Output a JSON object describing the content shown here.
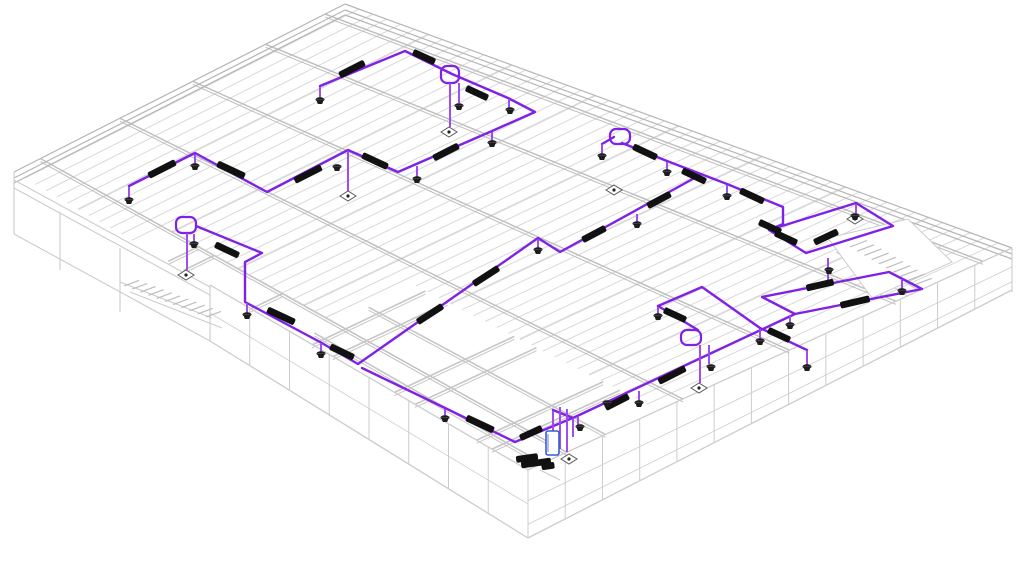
{
  "view": {
    "description": "3D isometric BIM view of single-storey building roof framing with electrical conduit layout",
    "width": 1024,
    "height": 563,
    "colors": {
      "background": "#ffffff",
      "conduit": "#8021e6",
      "conduit_light": "#9b45f0",
      "joist": "#d9d9d9",
      "girder": "#bdbdbd",
      "edge": "#b5b5b5",
      "wall": "#cccccc",
      "partition": "#c6c6c6",
      "fitting": "#111111",
      "fixture": "#1c1c1c",
      "plate_stroke": "#5a5a5a",
      "plate_fill": "#ffffff",
      "panel": "#3a5bd0"
    },
    "roof": {
      "corner_n": [
        345,
        4
      ],
      "corner_e": [
        1012,
        248
      ],
      "corner_s": [
        528,
        470
      ],
      "corner_w": [
        14,
        172
      ],
      "joist_count": 48,
      "joist_clips": [
        [
          0.0,
          1.0
        ],
        [
          0.25,
          0.92
        ],
        [
          0.56,
          0.73
        ]
      ],
      "girders": [
        0.06,
        0.24,
        0.46,
        0.68,
        0.92
      ],
      "edge_offsets": [
        0,
        6,
        11
      ]
    },
    "rooms": [
      [
        0.58,
        0.73,
        0.58,
        1.0
      ],
      [
        0.62,
        0.73,
        0.62,
        1.0
      ],
      [
        0.74,
        0.73,
        0.74,
        1.0
      ],
      [
        0.78,
        0.73,
        0.78,
        1.0
      ],
      [
        0.9,
        0.73,
        0.9,
        1.0
      ],
      [
        0.93,
        0.73,
        0.93,
        1.0
      ],
      [
        0.56,
        0.84,
        1.0,
        0.84
      ],
      [
        0.56,
        0.97,
        1.0,
        0.97
      ],
      [
        0.3,
        0.92,
        0.3,
        1.0
      ],
      [
        0.33,
        0.92,
        0.33,
        1.0
      ],
      [
        0.46,
        0.92,
        0.46,
        1.0
      ],
      [
        0.28,
        0.92,
        0.56,
        0.92
      ]
    ],
    "walls": [
      {
        "top": [
          [
            1012,
            248
          ],
          [
            528,
            470
          ]
        ],
        "drops": [
          42,
          68
        ],
        "verticals": 13,
        "bands": [
          0.45,
          0.8
        ]
      },
      {
        "top": [
          [
            210,
            285
          ],
          [
            528,
            470
          ]
        ],
        "drops": [
          56,
          68
        ],
        "verticals": 8,
        "bands": [
          0.5
        ]
      }
    ],
    "gray_lines": [
      [
        14,
        172,
        14,
        234
      ],
      [
        14,
        234,
        210,
        341
      ],
      [
        210,
        285,
        210,
        341
      ],
      [
        14,
        180,
        210,
        287
      ],
      [
        14,
        188,
        210,
        295
      ],
      [
        120,
        248,
        120,
        312
      ],
      [
        60,
        212,
        60,
        270
      ],
      [
        1012,
        248,
        1012,
        292
      ],
      [
        120,
        282,
        212,
        318
      ],
      [
        130,
        292,
        222,
        328
      ],
      [
        846,
        246,
        918,
        290
      ],
      [
        836,
        252,
        908,
        296
      ],
      [
        540,
        470,
        560,
        480
      ]
    ],
    "stair_void": [
      [
        828,
        238
      ],
      [
        908,
        219
      ],
      [
        952,
        262
      ],
      [
        872,
        298
      ]
    ],
    "stairs": [
      {
        "origin": [
          124,
          286
        ],
        "step": [
          8.2,
          3.1
        ],
        "n": 11,
        "tread": [
          15,
          -5.6
        ]
      },
      {
        "origin": [
          850,
          247
        ],
        "step": [
          7.2,
          4.2
        ],
        "n": 10,
        "tread": [
          17,
          -6.5
        ]
      }
    ],
    "conduit_runs": [
      [
        [
          129,
          186
        ],
        [
          195,
          153
        ],
        [
          267,
          192
        ],
        [
          348,
          150
        ],
        [
          398,
          172
        ],
        [
          492,
          131
        ],
        [
          535,
          112
        ],
        [
          508,
          98
        ],
        [
          452,
          74
        ],
        [
          405,
          51
        ],
        [
          320,
          86
        ]
      ],
      [
        [
          196,
          226
        ],
        [
          262,
          253
        ],
        [
          245,
          262
        ],
        [
          245,
          302
        ],
        [
          320,
          342
        ],
        [
          358,
          364
        ],
        [
          538,
          238
        ],
        [
          560,
          252
        ],
        [
          700,
          175
        ]
      ],
      [
        [
          622,
          143
        ],
        [
          667,
          161
        ],
        [
          727,
          184
        ],
        [
          783,
          207
        ],
        [
          783,
          224
        ],
        [
          769,
          230
        ],
        [
          856,
          203
        ],
        [
          893,
          226
        ],
        [
          806,
          253
        ],
        [
          769,
          230
        ]
      ],
      [
        [
          362,
          368
        ],
        [
          445,
          408
        ],
        [
          515,
          442
        ],
        [
          575,
          417
        ],
        [
          795,
          314
        ],
        [
          762,
          297
        ],
        [
          889,
          272
        ],
        [
          922,
          289
        ],
        [
          795,
          314
        ]
      ],
      [
        [
          658,
          306
        ],
        [
          702,
          287
        ],
        [
          760,
          328
        ],
        [
          807,
          350
        ]
      ],
      [
        [
          658,
          306
        ],
        [
          698,
          330
        ]
      ],
      [
        [
          553,
          410
        ],
        [
          573,
          418
        ]
      ],
      [
        [
          602,
          144
        ],
        [
          614,
          137
        ]
      ]
    ],
    "goosenecks": [
      [
        441,
        66,
        18,
        17
      ],
      [
        176,
        217,
        20,
        16
      ],
      [
        681,
        330,
        20,
        15
      ],
      [
        610,
        129,
        20,
        15
      ]
    ],
    "stems": [
      [
        129,
        187,
        198
      ],
      [
        195,
        154,
        164
      ],
      [
        320,
        87,
        98
      ],
      [
        348,
        151,
        191
      ],
      [
        417,
        166,
        177
      ],
      [
        492,
        132,
        141
      ],
      [
        509,
        99,
        108
      ],
      [
        450,
        83,
        127
      ],
      [
        459,
        83,
        103
      ],
      [
        187,
        233,
        270
      ],
      [
        194,
        234,
        242
      ],
      [
        247,
        303,
        313
      ],
      [
        321,
        343,
        352
      ],
      [
        538,
        239,
        248
      ],
      [
        637,
        214,
        222
      ],
      [
        667,
        162,
        170
      ],
      [
        727,
        185,
        194
      ],
      [
        602,
        144,
        154
      ],
      [
        856,
        204,
        213
      ],
      [
        700,
        345,
        383
      ],
      [
        709,
        345,
        364
      ],
      [
        639,
        391,
        401
      ],
      [
        578,
        417,
        425
      ],
      [
        760,
        329,
        339
      ],
      [
        807,
        350,
        365
      ],
      [
        658,
        307,
        314
      ],
      [
        790,
        315,
        323
      ],
      [
        902,
        279,
        289
      ],
      [
        828,
        258,
        280
      ],
      [
        445,
        409,
        416
      ],
      [
        553,
        411,
        449
      ],
      [
        560,
        407,
        449
      ],
      [
        567,
        409,
        452
      ],
      [
        573,
        418,
        437
      ]
    ],
    "fixtures": [
      [
        129,
        201
      ],
      [
        195,
        167
      ],
      [
        320,
        101
      ],
      [
        459,
        107
      ],
      [
        417,
        180
      ],
      [
        492,
        144
      ],
      [
        510,
        111
      ],
      [
        337,
        168
      ],
      [
        538,
        251
      ],
      [
        637,
        225
      ],
      [
        667,
        173
      ],
      [
        727,
        197
      ],
      [
        602,
        157
      ],
      [
        658,
        317
      ],
      [
        760,
        342
      ],
      [
        807,
        368
      ],
      [
        829,
        271
      ],
      [
        711,
        368
      ],
      [
        790,
        326
      ],
      [
        902,
        292
      ],
      [
        639,
        404
      ],
      [
        580,
        428
      ],
      [
        607,
        404
      ],
      [
        321,
        355
      ],
      [
        247,
        316
      ],
      [
        194,
        245
      ],
      [
        445,
        419
      ],
      [
        855,
        217
      ]
    ],
    "plates": [
      [
        449,
        132
      ],
      [
        348,
        196
      ],
      [
        186,
        275
      ],
      [
        699,
        388
      ],
      [
        569,
        459
      ],
      [
        855,
        219
      ],
      [
        614,
        190
      ]
    ],
    "fittings": [
      [
        162,
        169,
        -27,
        30
      ],
      [
        231,
        170,
        25,
        30
      ],
      [
        308,
        174,
        -27,
        30
      ],
      [
        375,
        161,
        25,
        28
      ],
      [
        446,
        152,
        -27,
        28
      ],
      [
        352,
        69,
        -27,
        28
      ],
      [
        424,
        57,
        25,
        24
      ],
      [
        477,
        93,
        25,
        24
      ],
      [
        227,
        250,
        25,
        26
      ],
      [
        281,
        316,
        25,
        30
      ],
      [
        342,
        352,
        25,
        26
      ],
      [
        430,
        314,
        -33,
        30
      ],
      [
        486,
        276,
        -33,
        30
      ],
      [
        594,
        234,
        -28,
        26
      ],
      [
        659,
        200,
        -28,
        26
      ],
      [
        645,
        152,
        25,
        26
      ],
      [
        694,
        176,
        25,
        26
      ],
      [
        752,
        196,
        25,
        26
      ],
      [
        770,
        227,
        25,
        24
      ],
      [
        786,
        238,
        25,
        24
      ],
      [
        826,
        237,
        -25,
        26
      ],
      [
        820,
        285,
        -13,
        28
      ],
      [
        855,
        302,
        -13,
        30
      ],
      [
        480,
        424,
        25,
        30
      ],
      [
        531,
        433,
        -25,
        24
      ],
      [
        617,
        402,
        -27,
        26
      ],
      [
        672,
        375,
        -27,
        30
      ],
      [
        675,
        315,
        25,
        24
      ],
      [
        779,
        335,
        25,
        24
      ],
      [
        527,
        458,
        -8,
        22
      ],
      [
        536,
        463,
        -8,
        30
      ],
      [
        548,
        466,
        -8,
        13
      ]
    ],
    "panel": {
      "x": 546,
      "y": 431,
      "w": 13,
      "h": 24
    }
  }
}
